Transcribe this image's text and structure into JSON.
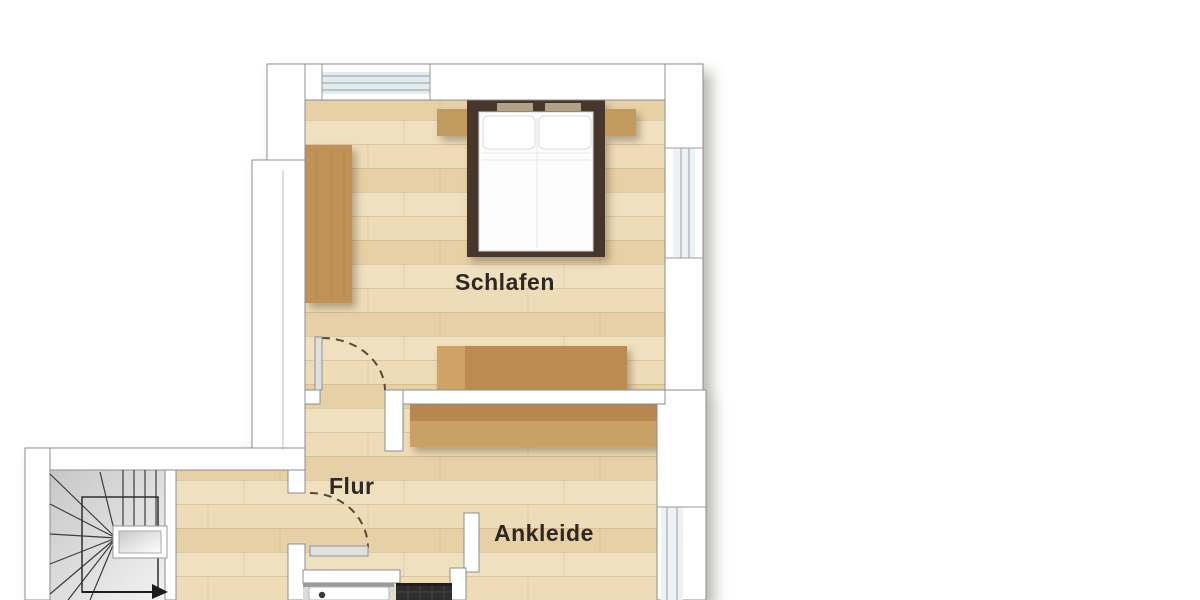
{
  "rooms": [
    {
      "id": "schlafen",
      "label": "Schlafen"
    },
    {
      "id": "flur",
      "label": "Flur"
    },
    {
      "id": "ankleide",
      "label": "Ankleide"
    }
  ],
  "icons": {
    "stair_direction_arrow": "right-pointing-triangle"
  },
  "palette": {
    "background": "#ffffff",
    "wall_fill": "#ffffff",
    "wall_outline": "#8c8c8c",
    "wood_floor": "#ebd8b2",
    "furniture_wood": "#c09257",
    "furniture_wood_dark": "#b8874f",
    "bed_frame": "#46362c",
    "mattress": "#fdfdfd",
    "stair_floor": "#d6d6d6",
    "stair_line": "#3c3c3c",
    "tile_dark": "#2d2d2d",
    "window_glass": "#e3ebee",
    "door_swing_arc": "#5a4632",
    "label_text": "#2f2822"
  }
}
